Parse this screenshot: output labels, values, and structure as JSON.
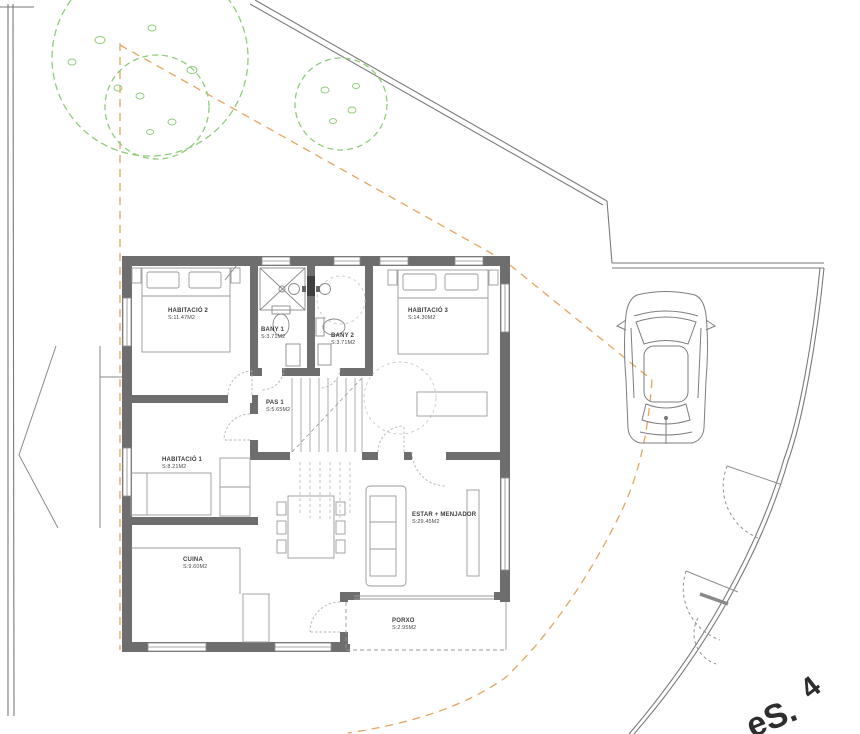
{
  "colors": {
    "wall": "#6e6e6e",
    "boundary_line": "#7a7a7a",
    "furniture_line": "#9a9a9a",
    "tree_green": "#8fcc7a",
    "setback_orange": "#e6a55e",
    "label_text": "#3d3d3d",
    "background": "#ffffff"
  },
  "plan": {
    "rooms": [
      {
        "name": "HABITACIÓ 2",
        "area": "S:11.47M2"
      },
      {
        "name": "BANY 1",
        "area": "S:3.71M2"
      },
      {
        "name": "BANY 2",
        "area": "S:3.71M2"
      },
      {
        "name": "HABITACIÓ 3",
        "area": "S:14.30M2"
      },
      {
        "name": "PAS 1",
        "area": "S:5.65M2"
      },
      {
        "name": "HABITACIÓ 1",
        "area": "S:8.21M2"
      },
      {
        "name": "CUINA",
        "area": "S:9.60M2"
      },
      {
        "name": "ESTAR + MENJADOR",
        "area": "S:29.45M2"
      },
      {
        "name": "PORXO",
        "area": "S:2.95M2"
      }
    ]
  },
  "corner_text": {
    "fragment": "eS.",
    "number": "4"
  }
}
